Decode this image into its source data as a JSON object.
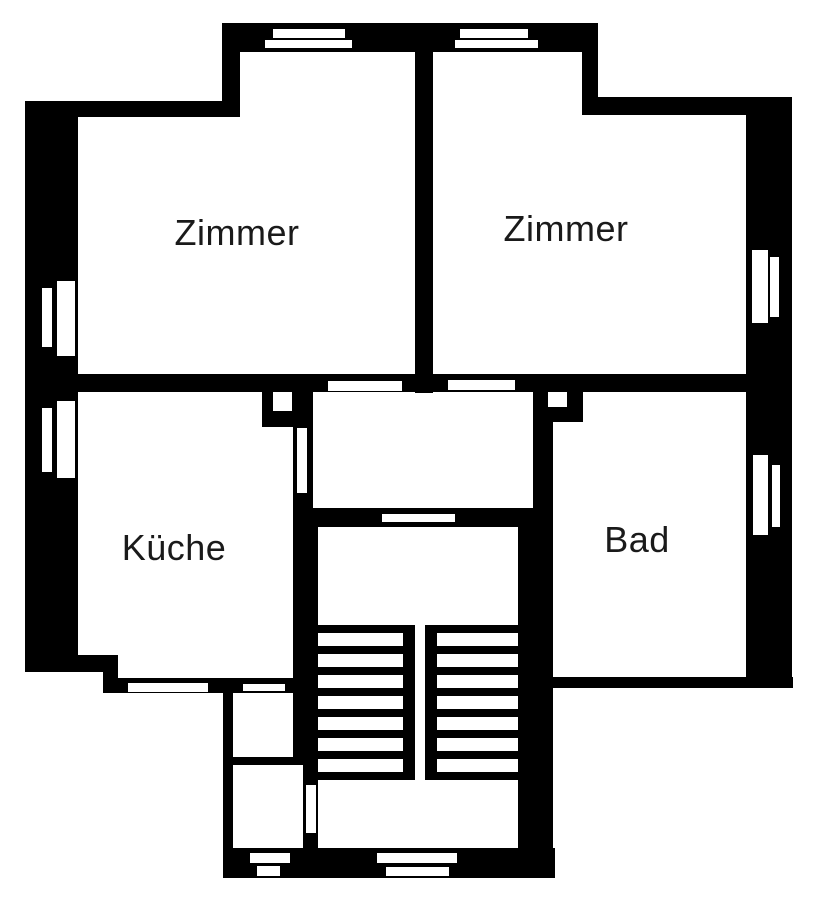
{
  "floorplan": {
    "rooms": [
      {
        "id": "zimmer-left",
        "label": "Zimmer"
      },
      {
        "id": "zimmer-right",
        "label": "Zimmer"
      },
      {
        "id": "kueche",
        "label": "Küche"
      },
      {
        "id": "bad",
        "label": "Bad"
      }
    ],
    "colors": {
      "wall": "#000000",
      "background": "#ffffff",
      "text": "#1a1a1a"
    }
  }
}
